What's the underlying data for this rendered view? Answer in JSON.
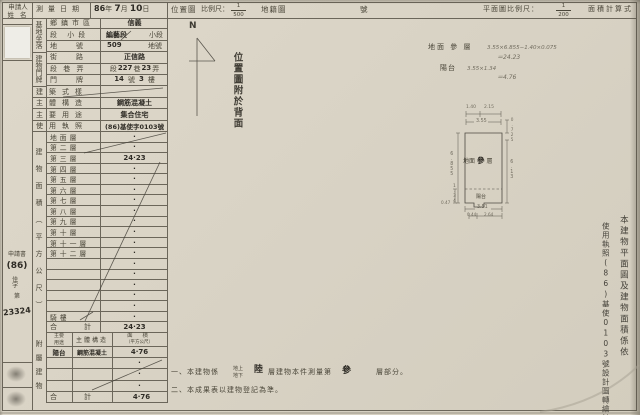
{
  "colors": {
    "paper": "#d9d3c5",
    "line": "#6b665a",
    "ink": "#4a4639",
    "handwriting": "#2e2b25"
  },
  "top": {
    "applicant_l1": "申請人",
    "applicant_l2": "姓 名",
    "date_label": "測量日期",
    "date_year": "86",
    "date_y": "年",
    "date_month": "7",
    "date_m": "月",
    "date_day": "10",
    "date_d": "日",
    "loc_map": "位置圖",
    "scale_label": "比例尺：",
    "loc_num": "1",
    "loc_den": "500",
    "cadastre": "地籍圖",
    "sheet_no": "號",
    "plan_scale_label": "平面圖比例尺：",
    "plan_num": "1",
    "plan_den": "200",
    "area_calc": "面積計算式"
  },
  "leftmargin": {
    "doc": "申請書",
    "year": "(86)",
    "word": "佳字",
    "ordinal": "第",
    "number": "23324"
  },
  "site": {
    "group": "基地坐落",
    "r1l": "鄉鎮市區",
    "r1v": "信義",
    "r2l": "段 小段",
    "r2v1": "編藝段",
    "r2v2": "小段",
    "r3l": "地　號",
    "r3v1": "509",
    "r3v2": "地號"
  },
  "door": {
    "group": "建物門牌",
    "r1l": "街　路",
    "r1v": "正信路",
    "r2l": "段 巷 弄",
    "seg": "段",
    "seg_no": "227",
    "lane": "巷",
    "lane_no": "23",
    "alley": "弄",
    "r3l": "門　牌",
    "no": "14",
    "no_u": "號",
    "fl": "3",
    "fl_u": "樓"
  },
  "build": {
    "style_l": "建築式樣",
    "struct_l": "主體構造",
    "struct_v": "鋼筋混凝土",
    "use_l": "主要用途",
    "use_v": "集合住宅",
    "lic_l": "使用執照",
    "lic_v": "(86)基使字0103號"
  },
  "floors": {
    "side": "建物面積（平方公尺）",
    "rows": [
      {
        "label": "地面層",
        "value": "·"
      },
      {
        "label": "第二層",
        "value": "·"
      },
      {
        "label": "第三層",
        "value": "24·23"
      },
      {
        "label": "第四層",
        "value": "·"
      },
      {
        "label": "第五層",
        "value": "·"
      },
      {
        "label": "第六層",
        "value": "·"
      },
      {
        "label": "第七層",
        "value": "·"
      },
      {
        "label": "第八層",
        "value": "·"
      },
      {
        "label": "第九層",
        "value": "·"
      },
      {
        "label": "第十層",
        "value": "·"
      },
      {
        "label": "第十一層",
        "value": "·"
      },
      {
        "label": "第十二層",
        "value": "·"
      },
      {
        "label": "",
        "value": "·"
      },
      {
        "label": "",
        "value": "·"
      },
      {
        "label": "",
        "value": "·"
      },
      {
        "label": "",
        "value": "·"
      },
      {
        "label": "",
        "value": "·"
      },
      {
        "label": "騎樓",
        "value": "·"
      }
    ],
    "total_label": "合　計",
    "total_value": "24·23"
  },
  "annex": {
    "side": "附屬建物",
    "h_use1": "主要",
    "h_use2": "用途",
    "h_struct": "主體構造",
    "h_area1": "面 積",
    "h_area2": "（平方公尺）",
    "rows": [
      {
        "use": "陽台",
        "struct": "鋼筋混凝土",
        "area": "4·76"
      },
      {
        "use": "",
        "struct": "",
        "area": "·"
      },
      {
        "use": "",
        "struct": "",
        "area": "·"
      },
      {
        "use": "",
        "struct": "",
        "area": "·"
      }
    ],
    "total_label": "合　計",
    "total_value": "4·76"
  },
  "map": {
    "north": "N",
    "back_note": "位置圖附於背面"
  },
  "calc": {
    "l1_label": "地面 參 層",
    "l1_formula": "3.55×6.855−1.40×0.075",
    "l1_result": "＝24.23",
    "l2_label": "陽台",
    "l2_formula": "3.55×1.34",
    "l2_result": "＝4.76"
  },
  "plan": {
    "title_1": "地面",
    "title_2": "參",
    "title_3": "層",
    "balcony": "陽台",
    "d_top1": "1.40",
    "d_top2": "2.15",
    "d_top": "3.55",
    "d_left": "6.855",
    "d_left2": "1.34",
    "d_left3": "0.47",
    "d_right1": "0.725",
    "d_right": "6.13",
    "d_bottom": "3.51",
    "d_b1": "0.44",
    "d_b2": "2.64"
  },
  "sidenote": {
    "col_a": "本建物平面圖及建物面積係依",
    "col_b": "使用執照(86)基使0103號設計圖轉繪計算"
  },
  "notes": {
    "n1a": "一、本建物係",
    "n1_up": "地上",
    "n1_down": "地下",
    "n1_floors": "陸",
    "n1b": "層建物本件測量第",
    "n1_num": "參",
    "n1c": "層部分。",
    "n2": "二、本成果表以建物登記為準。"
  }
}
